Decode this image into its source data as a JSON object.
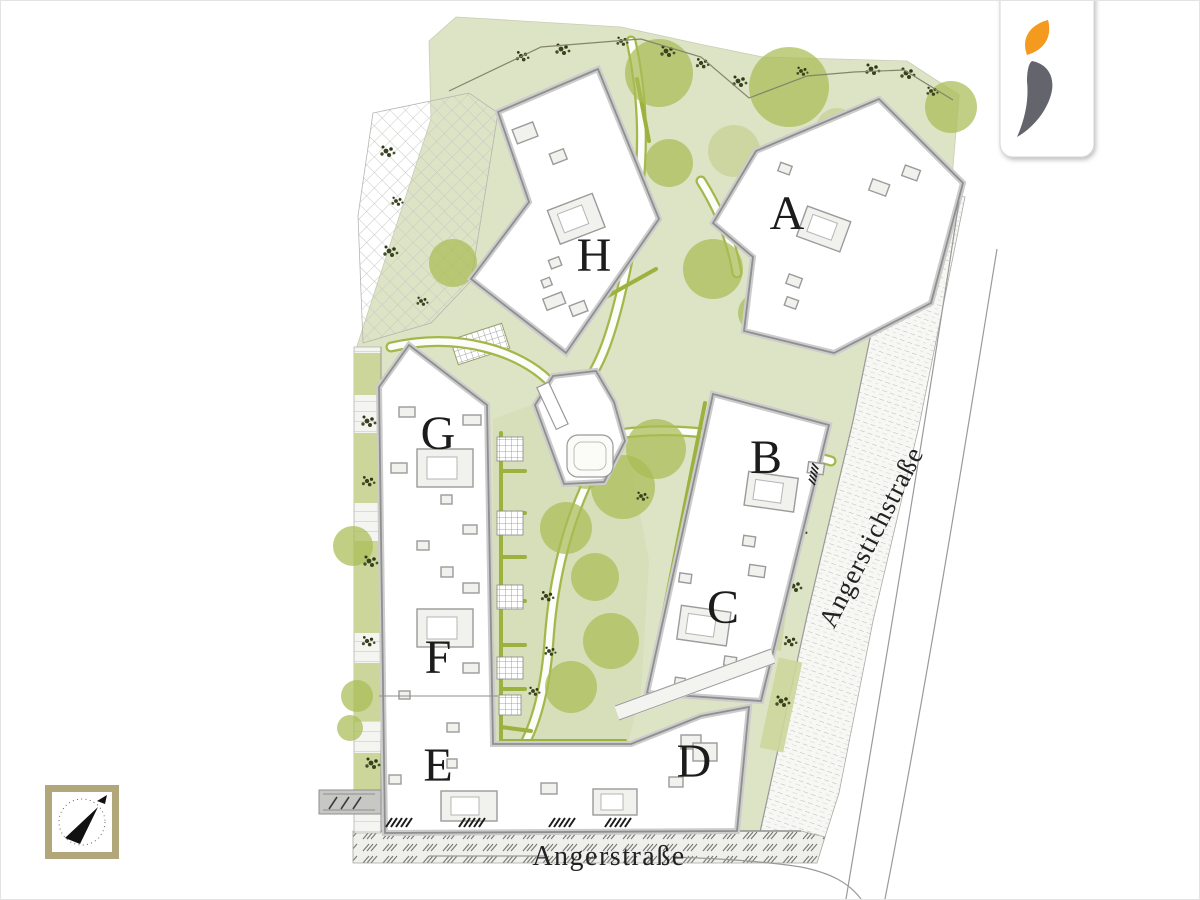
{
  "plan": {
    "buildings": [
      {
        "id": "A",
        "label": "A"
      },
      {
        "id": "B",
        "label": "B"
      },
      {
        "id": "C",
        "label": "C"
      },
      {
        "id": "D",
        "label": "D"
      },
      {
        "id": "E",
        "label": "E"
      },
      {
        "id": "F",
        "label": "F"
      },
      {
        "id": "G",
        "label": "G"
      },
      {
        "id": "H",
        "label": "H"
      }
    ],
    "streets": [
      {
        "name": "Angerstraße"
      },
      {
        "name": "Angerstichstraße"
      }
    ]
  },
  "logo": {
    "icon": "flame-swoosh-logo",
    "flame_color": "#F49A1E",
    "swoosh_color": "#64646C"
  },
  "compass": {
    "icon": "compass-north-arrow",
    "frame_color": "#B2A77B"
  },
  "palette": {
    "lawn": "#DDE3C5",
    "courtyard_lawn": "#D7DEBA",
    "tree": "#A9BC55",
    "hedge": "#9CB23F",
    "building_fill": "#FFFFFF",
    "building_outline": "#8F8F8F",
    "paving_line": "#C8C8C4",
    "label_color": "#1C1C1C"
  }
}
